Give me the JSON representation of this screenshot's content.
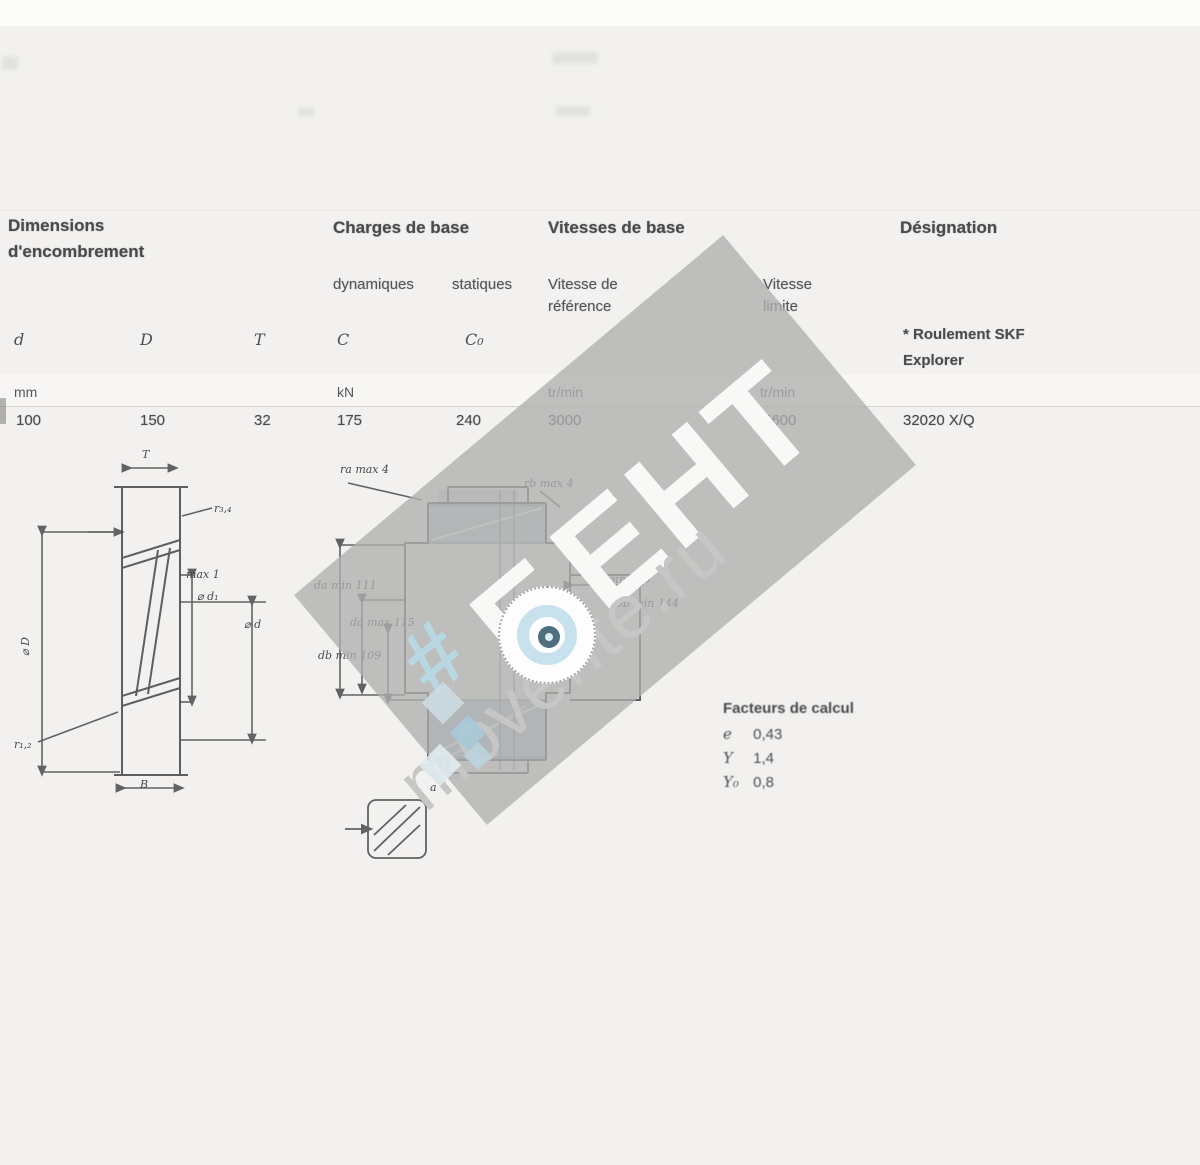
{
  "table": {
    "groups": {
      "dimensions_l1": "Dimensions",
      "dimensions_l2": "d'encombrement",
      "loads": "Charges de base",
      "speeds": "Vitesses de base",
      "designation": "Désignation"
    },
    "subheaders": {
      "dynamic": "dynamiques",
      "static": "statiques",
      "ref_l1": "Vitesse de",
      "ref_l2": "référence",
      "lim_l1": "Vitesse",
      "lim_l2": "limite",
      "note_l1": "* Roulement SKF",
      "note_l2": "Explorer"
    },
    "columns": [
      "d",
      "D",
      "T",
      "C",
      "C₀"
    ],
    "units": [
      "mm",
      "kN",
      "tr/min",
      "tr/min"
    ],
    "row": {
      "d": "100",
      "D": "150",
      "T": "32",
      "C": "175",
      "C0": "240",
      "v_ref": "3000",
      "v_lim": "5600",
      "designation": "32020 X/Q"
    }
  },
  "calc": {
    "title": "Facteurs de calcul",
    "rows": [
      {
        "label": "e",
        "value": "0,43"
      },
      {
        "label": "Y",
        "value": "1,4"
      },
      {
        "label": "Y₀",
        "value": "0,8"
      }
    ]
  },
  "left_fig": {
    "T": "T",
    "r34": "r₃,₄",
    "max1": "max 1",
    "d1": "⌀ d₁",
    "D": "⌀ D",
    "d": "⌀ d",
    "r12": "r₁,₂",
    "B": "B"
  },
  "mid_fig": {
    "ra": "ra max 4",
    "rb": "rb max 4",
    "da_min": "da min 111",
    "da_max": "da max 115",
    "db_min": "db min 109",
    "Da_min": "Da min 139",
    "Db_min": "Db min 144",
    "a": "a"
  },
  "watermark": {
    "big": "БЕНТ",
    "site": "movente.ru",
    "hash": "#",
    "band_color": "#b0afae",
    "accent_blue": "#c7e2ec"
  }
}
